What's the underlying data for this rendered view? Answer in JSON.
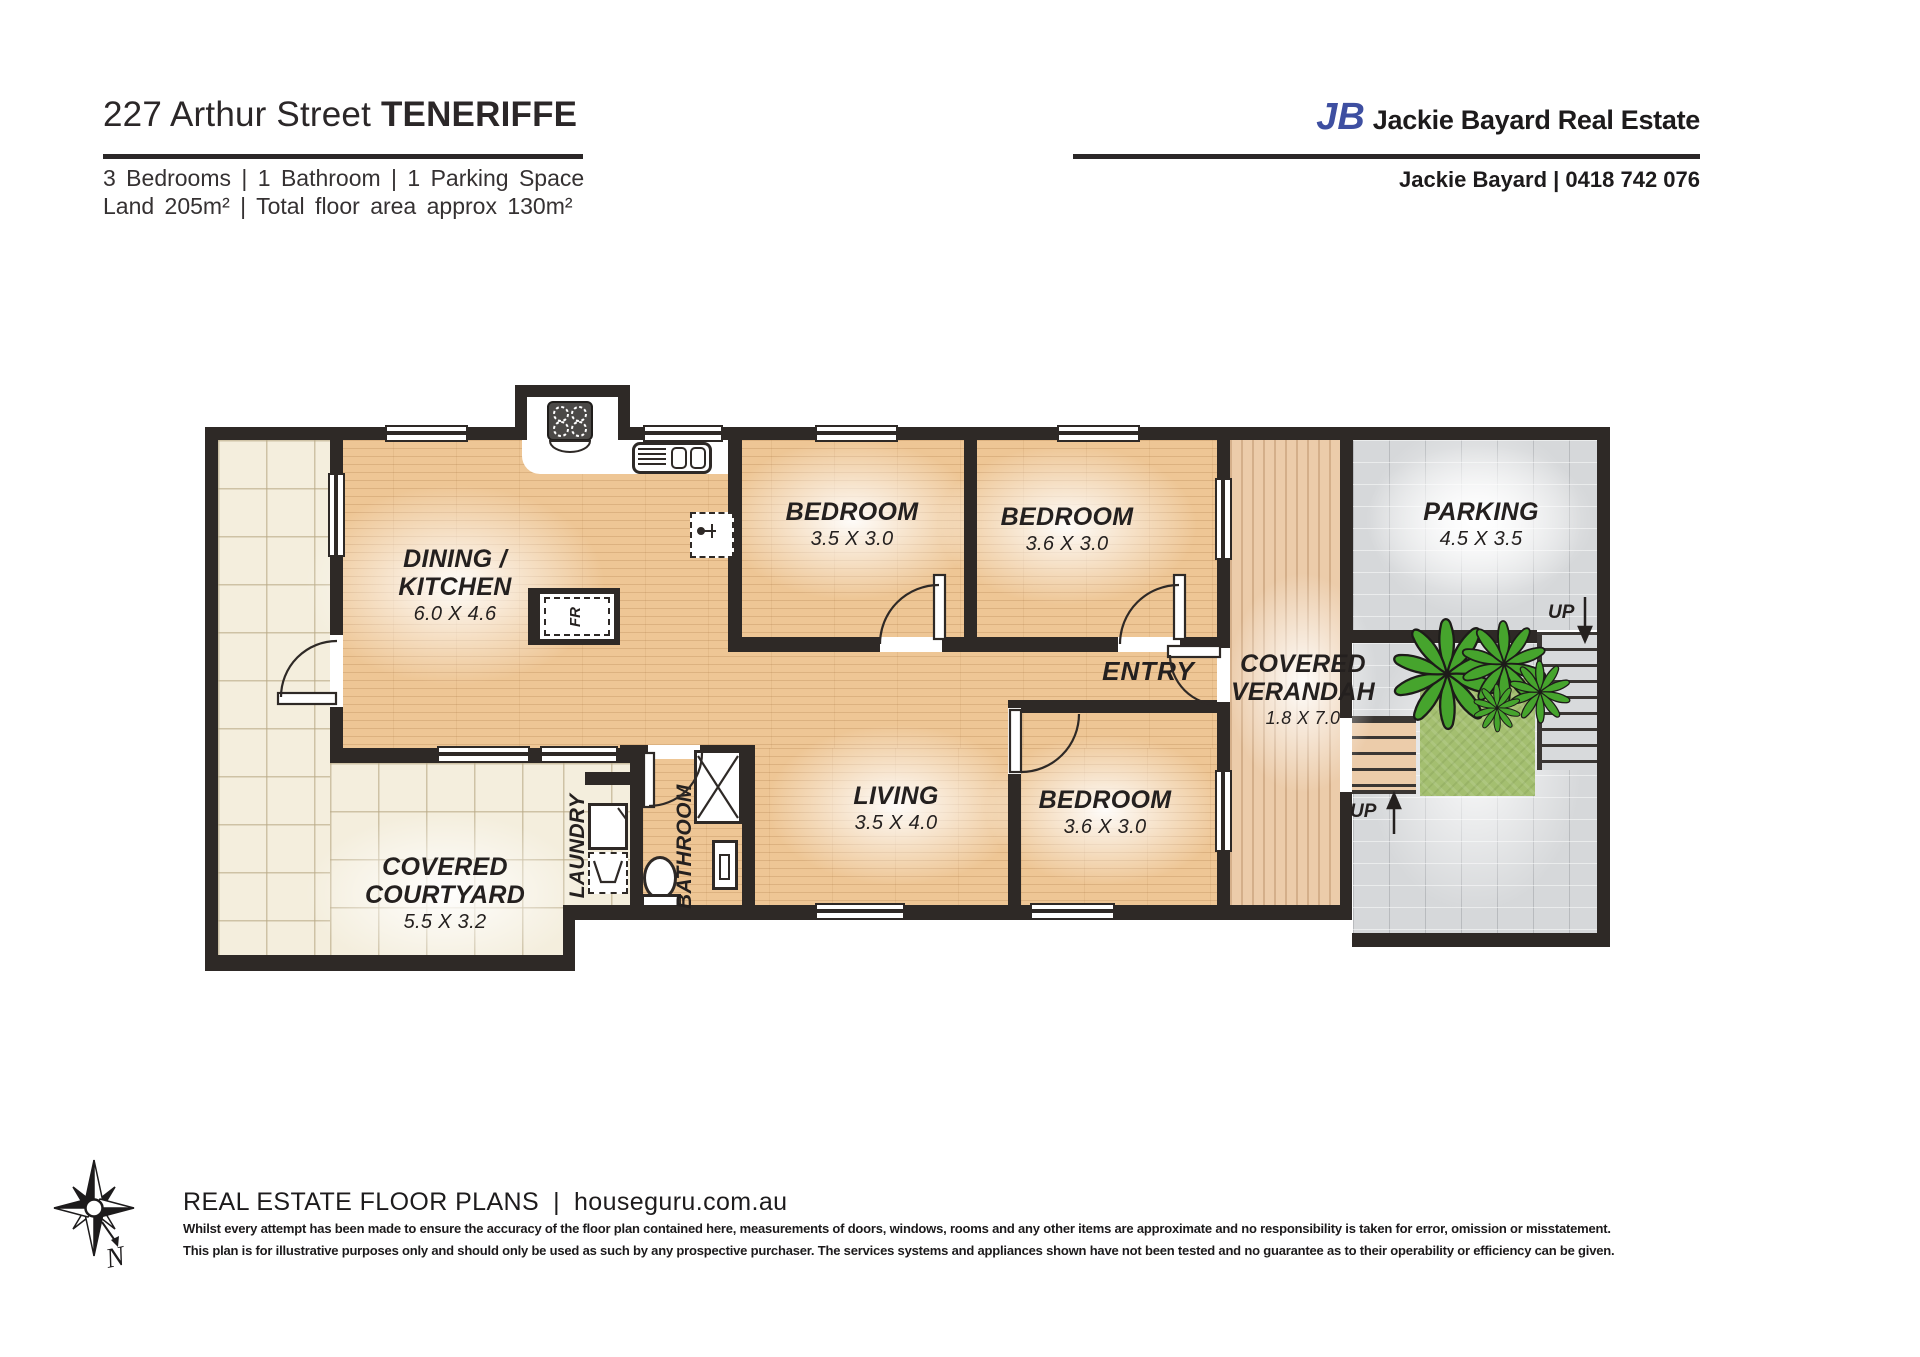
{
  "header": {
    "address": "227 Arthur Street",
    "suburb": "TENERIFFE",
    "specs": "3 Bedrooms | 1 Bathroom | 1 Parking Space",
    "land": "Land 205m² | Total floor area approx 130m²"
  },
  "agency": {
    "logo": "JB",
    "name": "Jackie Bayard Real Estate",
    "contact": "Jackie Bayard | 0418 742 076"
  },
  "plan": {
    "dining": {
      "l1": "DINING /",
      "l2": "KITCHEN",
      "dims": "6.0 X 4.6"
    },
    "bedroom1": {
      "l1": "BEDROOM",
      "dims": "3.5 X 3.0"
    },
    "bedroom2": {
      "l1": "BEDROOM",
      "dims": "3.6 X 3.0"
    },
    "bedroom3": {
      "l1": "BEDROOM",
      "dims": "3.6 X 3.0"
    },
    "living": {
      "l1": "LIVING",
      "dims": "3.5 X 4.0"
    },
    "parking": {
      "l1": "PARKING",
      "dims": "4.5 X 3.5"
    },
    "verandah": {
      "l1": "COVERED",
      "l2": "VERANDAH",
      "dims": "1.8 X 7.0"
    },
    "courtyard": {
      "l1": "COVERED",
      "l2": "COURTYARD",
      "dims": "5.5 X 3.2"
    },
    "entry": "ENTRY",
    "laundry": "LAUNDRY",
    "bathroom": "BATHROOM",
    "fridge": "FR",
    "up_parking": "UP",
    "up_verandah": "UP",
    "compass_north": "N"
  },
  "colors": {
    "logo_blue": "#3e4fa1",
    "wall": "#2e2926",
    "wood_floor": "#eec695",
    "deck": "#ecccaa",
    "tile": "#f4eedd",
    "paving": "#d6d8da",
    "grass": "#a4bf70"
  },
  "footer": {
    "brand": "REAL ESTATE FLOOR PLANS",
    "separator": "|",
    "website": "houseguru.com.au",
    "disclaimer1": "Whilst every attempt has been made to ensure the accuracy of the floor plan contained here, measurements of doors, windows, rooms and any other items are approximate and no responsibility is taken for error, omission or misstatement.",
    "disclaimer2": "This plan is for illustrative purposes only and should only be used as such by any prospective purchaser. The services systems and appliances shown have not been tested and no guarantee as to their operability or efficiency can be given."
  }
}
